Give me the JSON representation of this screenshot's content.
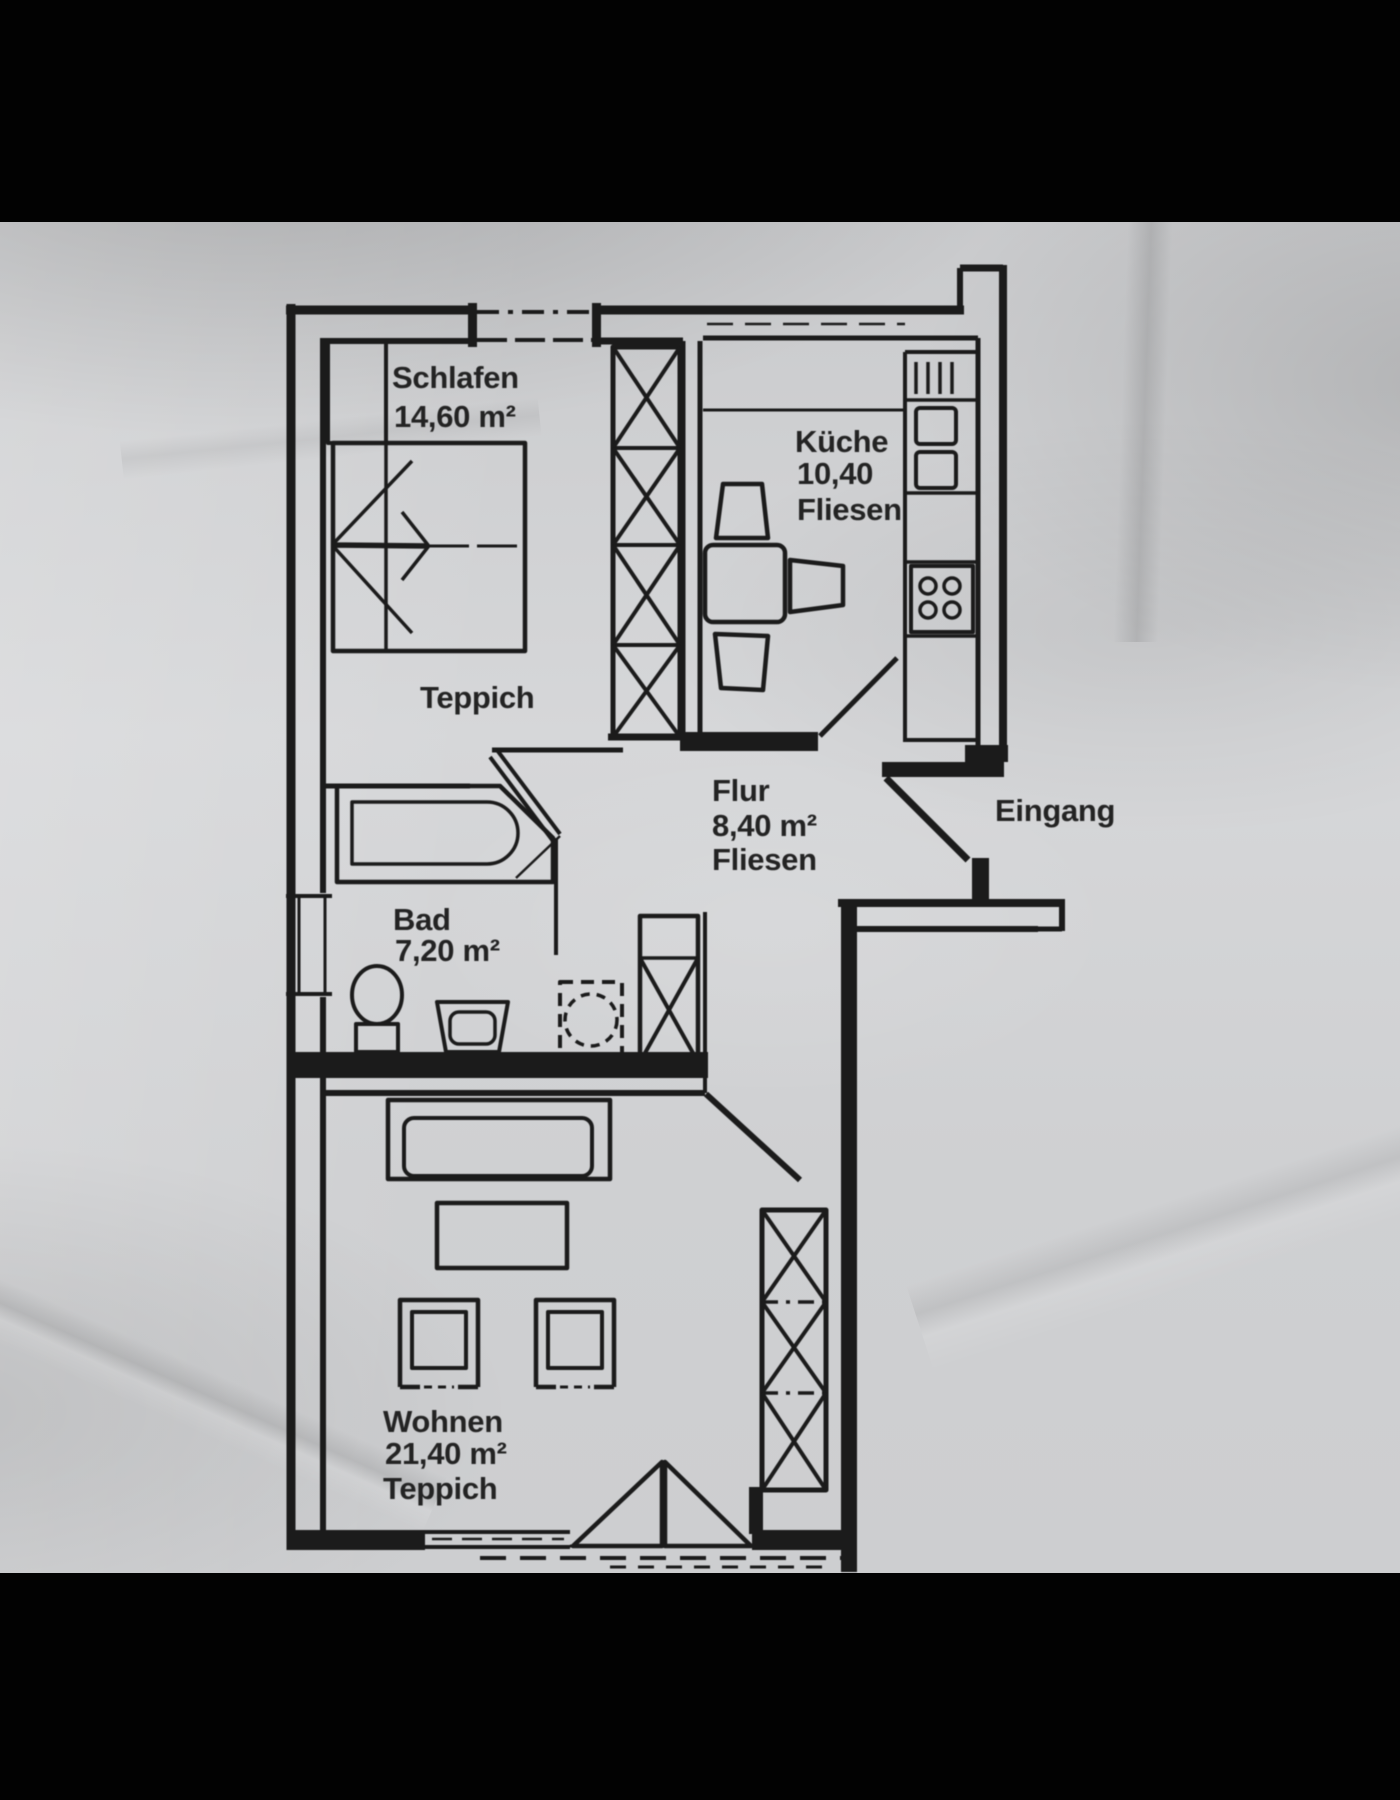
{
  "photo": {
    "letterbox_color": "#020202",
    "paper_color": "#d0d1d3",
    "ink_color": "#1b1b1b"
  },
  "plan": {
    "rooms": {
      "schlafen": {
        "name": "Schlafen",
        "area": "14,60 m²",
        "floor": "Teppich"
      },
      "kueche": {
        "name": "Küche",
        "area": "10,40",
        "floor": "Fliesen"
      },
      "flur": {
        "name": "Flur",
        "area": "8,40 m²",
        "floor": "Fliesen"
      },
      "bad": {
        "name": "Bad",
        "area": "7,20 m²"
      },
      "wohnen": {
        "name": "Wohnen",
        "area": "21,40 m²",
        "floor": "Teppich"
      },
      "eingang": {
        "name": "Eingang"
      }
    }
  }
}
